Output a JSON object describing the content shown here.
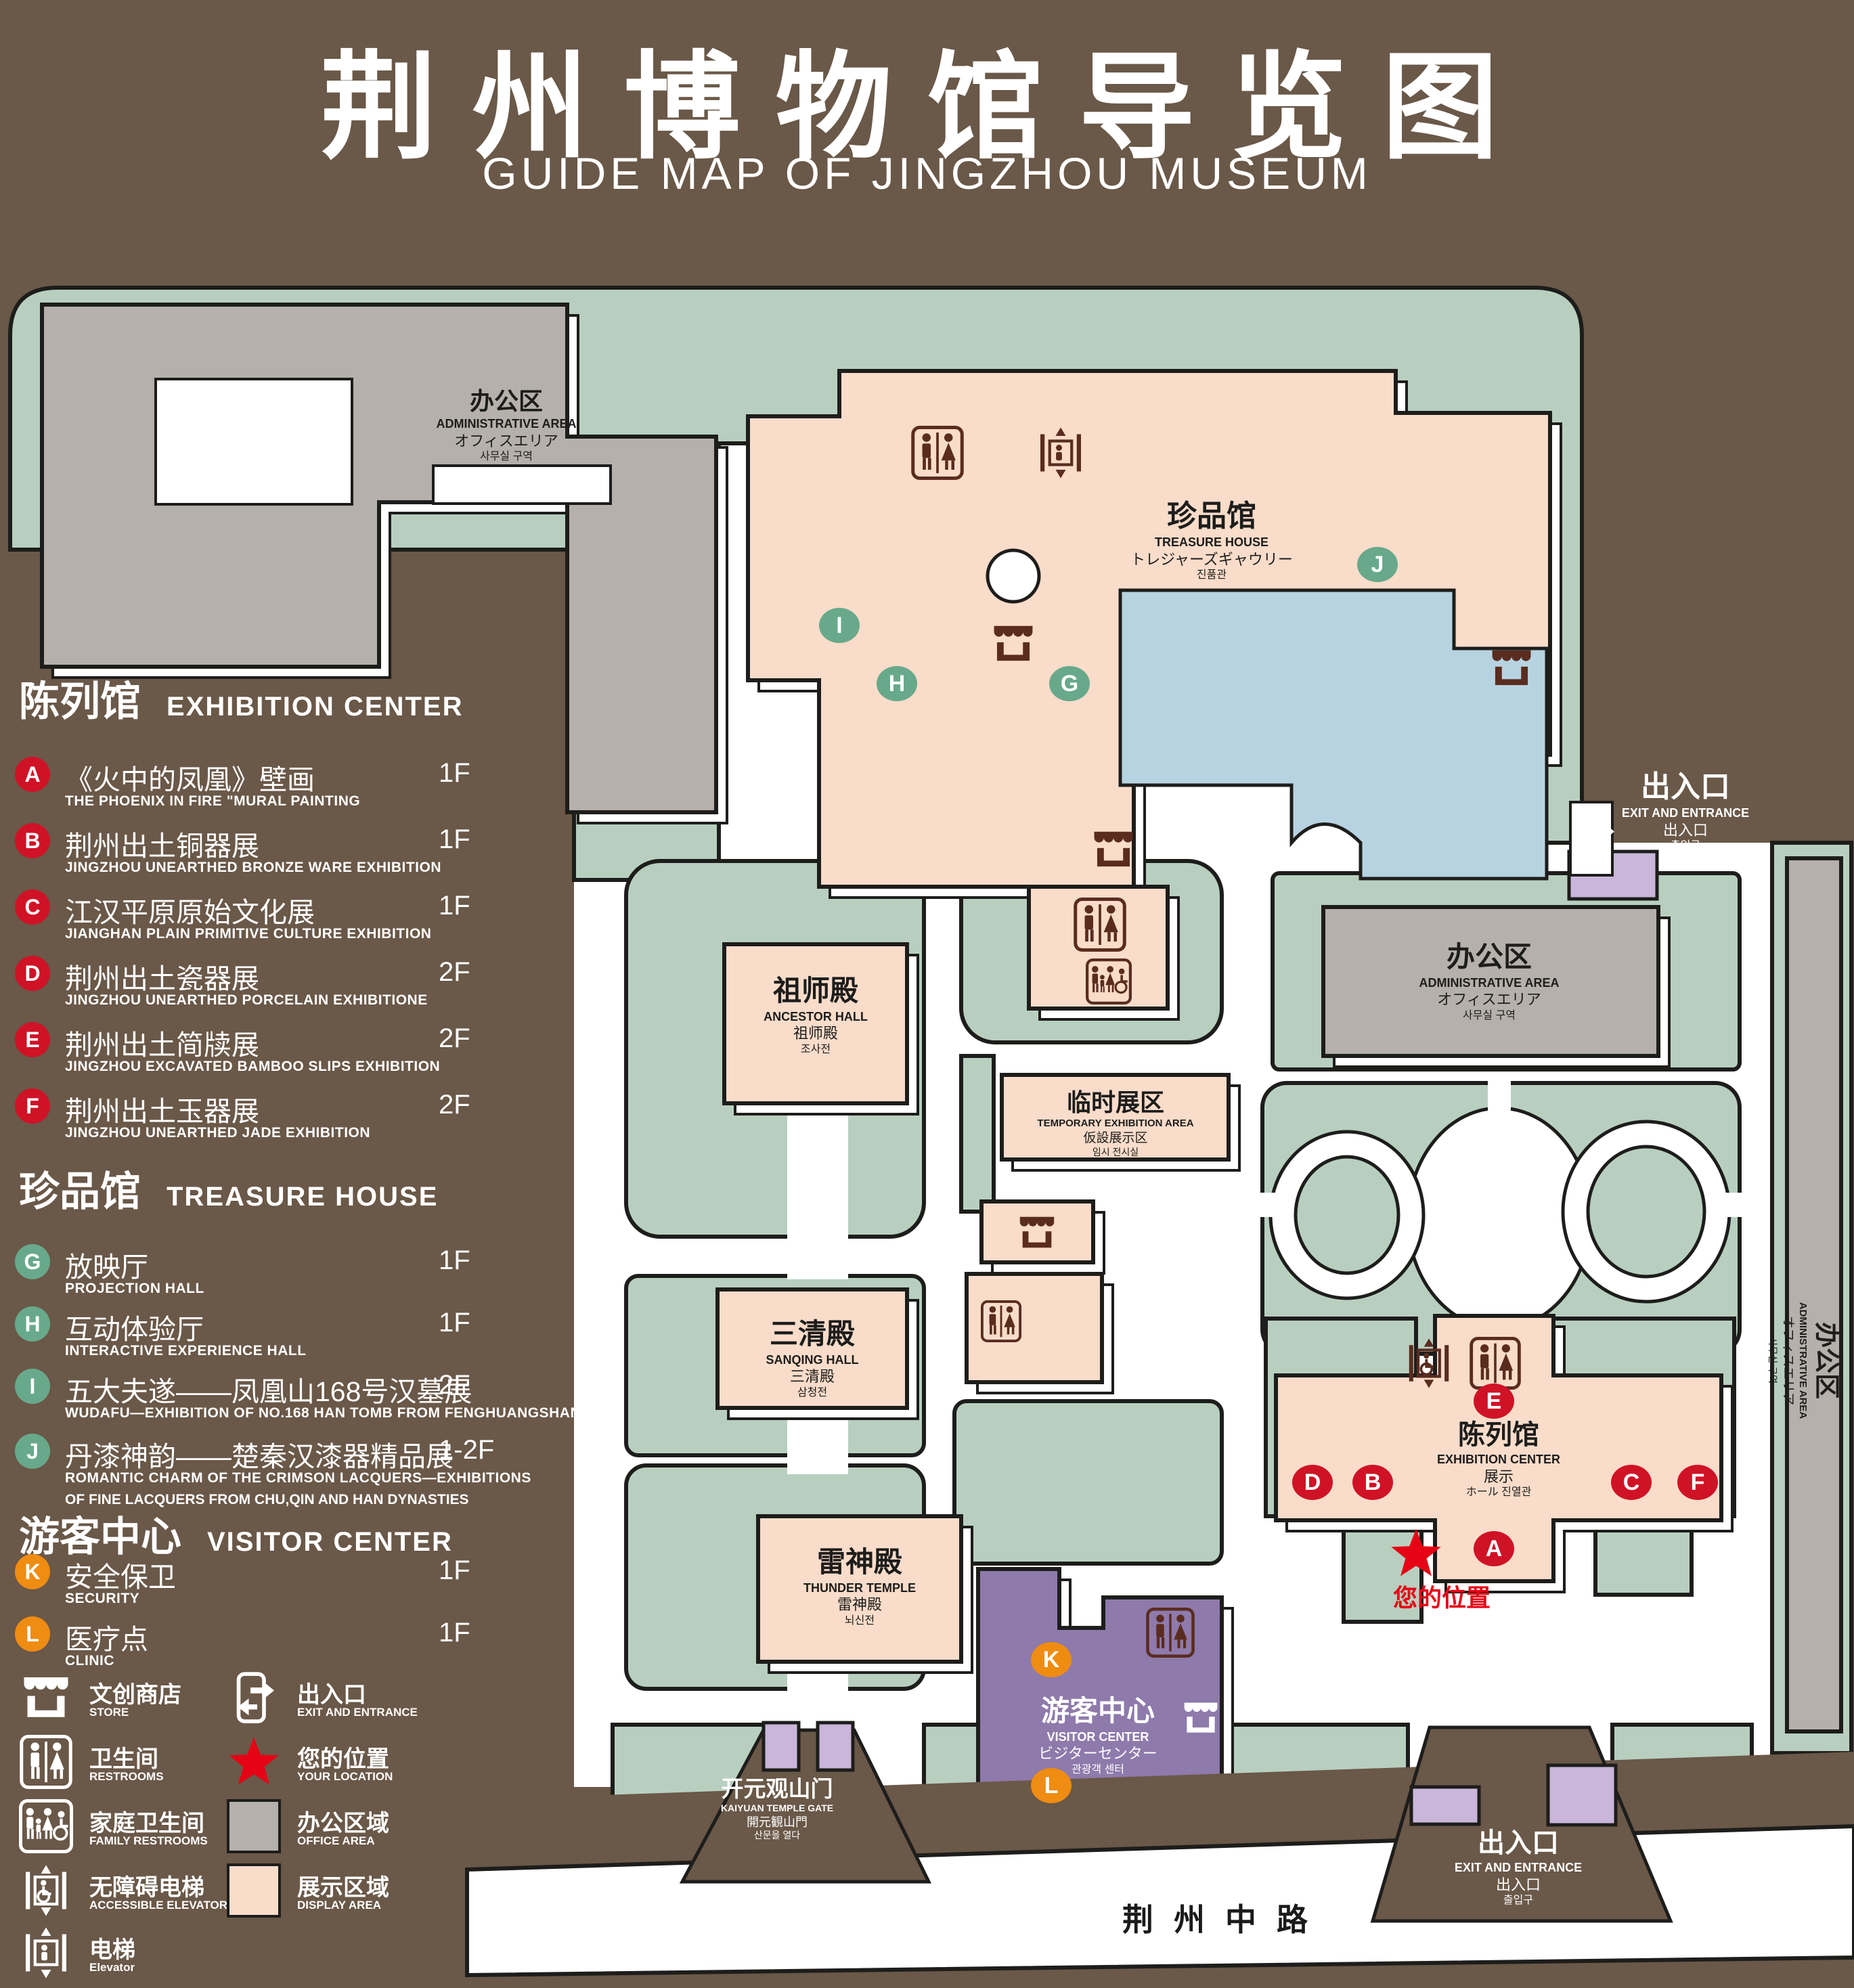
{
  "title": {
    "zh": "荆州博物馆导览图",
    "en": "GUIDE MAP OF JINGZHOU MUSEUM"
  },
  "legend": {
    "sections": {
      "exhibition": {
        "zh": "陈列馆",
        "en": "EXHIBITION CENTER"
      },
      "treasure": {
        "zh": "珍品馆",
        "en": "TREASURE HOUSE"
      },
      "visitor": {
        "zh": "游客中心",
        "en": "VISITOR CENTER"
      }
    },
    "items": {
      "a": {
        "letter": "A",
        "zh": "《火中的凤凰》壁画",
        "en": "THE PHOENIX IN FIRE \"MURAL PAINTING",
        "floor": "1F"
      },
      "b": {
        "letter": "B",
        "zh": "荆州出土铜器展",
        "en": "JINGZHOU UNEARTHED BRONZE WARE EXHIBITION",
        "floor": "1F"
      },
      "c": {
        "letter": "C",
        "zh": "江汉平原原始文化展",
        "en": "JIANGHAN PLAIN PRIMITIVE CULTURE EXHIBITION",
        "floor": "1F"
      },
      "d": {
        "letter": "D",
        "zh": "荆州出土瓷器展",
        "en": "JINGZHOU UNEARTHED PORCELAIN EXHIBITIONE",
        "floor": "2F"
      },
      "e": {
        "letter": "E",
        "zh": "荆州出土简牍展",
        "en": "JINGZHOU EXCAVATED BAMBOO SLIPS EXHIBITION",
        "floor": "2F"
      },
      "f": {
        "letter": "F",
        "zh": "荆州出土玉器展",
        "en": "JINGZHOU UNEARTHED JADE EXHIBITION",
        "floor": "2F"
      },
      "g": {
        "letter": "G",
        "zh": "放映厅",
        "en": "PROJECTION HALL",
        "floor": "1F"
      },
      "h": {
        "letter": "H",
        "zh": "互动体验厅",
        "en": "INTERACTIVE EXPERIENCE HALL",
        "floor": "1F"
      },
      "i": {
        "letter": "I",
        "zh": "五大夫遂——凤凰山168号汉墓展",
        "en": "WUDAFU—EXHIBITION OF NO.168 HAN TOMB FROM FENGHUANGSHAN",
        "floor": "2F"
      },
      "j": {
        "letter": "J",
        "zh": "丹漆神韵——楚秦汉漆器精品展",
        "en": "ROMANTIC CHARM OF THE CRIMSON LACQUERS—EXHIBITIONS",
        "en2": "OF FINE LACQUERS FROM CHU,QIN AND HAN DYNASTIES",
        "floor": "1-2F"
      },
      "k": {
        "letter": "K",
        "zh": "安全保卫",
        "en": "SECURITY",
        "floor": "1F"
      },
      "l": {
        "letter": "L",
        "zh": "医疗点",
        "en": "CLINIC",
        "floor": "1F"
      }
    },
    "key": {
      "store": {
        "zh": "文创商店",
        "en": "STORE"
      },
      "restrooms": {
        "zh": "卫生间",
        "en": "RESTROOMS"
      },
      "family": {
        "zh": "家庭卫生间",
        "en": "FAMILY RESTROOMS"
      },
      "accessible": {
        "zh": "无障碍电梯",
        "en": "ACCESSIBLE ELEVATOR"
      },
      "elevator": {
        "zh": "电梯",
        "en": "Elevator"
      },
      "exit": {
        "zh": "出入口",
        "en": "EXIT AND ENTRANCE"
      },
      "location": {
        "zh": "您的位置",
        "en": "YOUR LOCATION"
      },
      "office": {
        "zh": "办公区域",
        "en": "OFFICE AREA"
      },
      "display": {
        "zh": "展示区域",
        "en": "DISPLAY AREA"
      }
    }
  },
  "map": {
    "admin": {
      "zh": "办公区",
      "en": "ADMINISTRATIVE AREA",
      "ja": "オフィスエリア",
      "ko": "사무실 구역"
    },
    "treasure": {
      "zh": "珍品馆",
      "en": "TREASURE HOUSE",
      "ja": "トレジャーズギャウリー",
      "ko": "진품관"
    },
    "ancestor": {
      "zh": "祖师殿",
      "en": "ANCESTOR HALL",
      "ja": "祖师殿",
      "ko": "조사전"
    },
    "sanqing": {
      "zh": "三清殿",
      "en": "SANQING HALL",
      "ja": "三清殿",
      "ko": "삼청전"
    },
    "thunder": {
      "zh": "雷神殿",
      "en": "THUNDER TEMPLE",
      "ja": "雷神殿",
      "ko": "뇌신전"
    },
    "temporary": {
      "zh": "临时展区",
      "en": "TEMPORARY EXHIBITION AREA",
      "ja": "仮設展示区",
      "ko": "임시 전시실"
    },
    "visitor": {
      "zh": "游客中心",
      "en": "VISITOR CENTER",
      "ja": "ビジターセンター",
      "ko": "관광객 센터"
    },
    "exhibition": {
      "zh": "陈列馆",
      "en": "EXHIBITION CENTER",
      "ja": "展示",
      "ja2": "ホール 진열관"
    },
    "exit": {
      "zh": "出入口",
      "en": "EXIT AND ENTRANCE",
      "ja": "出入口",
      "ko": "출입구"
    },
    "gate": {
      "zh": "开元观山门",
      "en": "KAIYUAN TEMPLE GATE",
      "ja": "開元観山門",
      "ko": "산문을 열다"
    },
    "road": "荆州中路",
    "location": "您的位置"
  },
  "colors": {
    "background": "#6a5848",
    "green": "#b8cfc0",
    "pink": "#f9dcca",
    "gray": "#b5b0ab",
    "lake_blue": "#b7d3e1",
    "visitor_purple": "#8e7aab",
    "lavender": "#c9b6da",
    "marker_red": "#d01226",
    "marker_green": "#68a98b",
    "marker_orange": "#ef8c12",
    "icon_maroon": "#5a2c20",
    "location_red": "#e60315"
  }
}
